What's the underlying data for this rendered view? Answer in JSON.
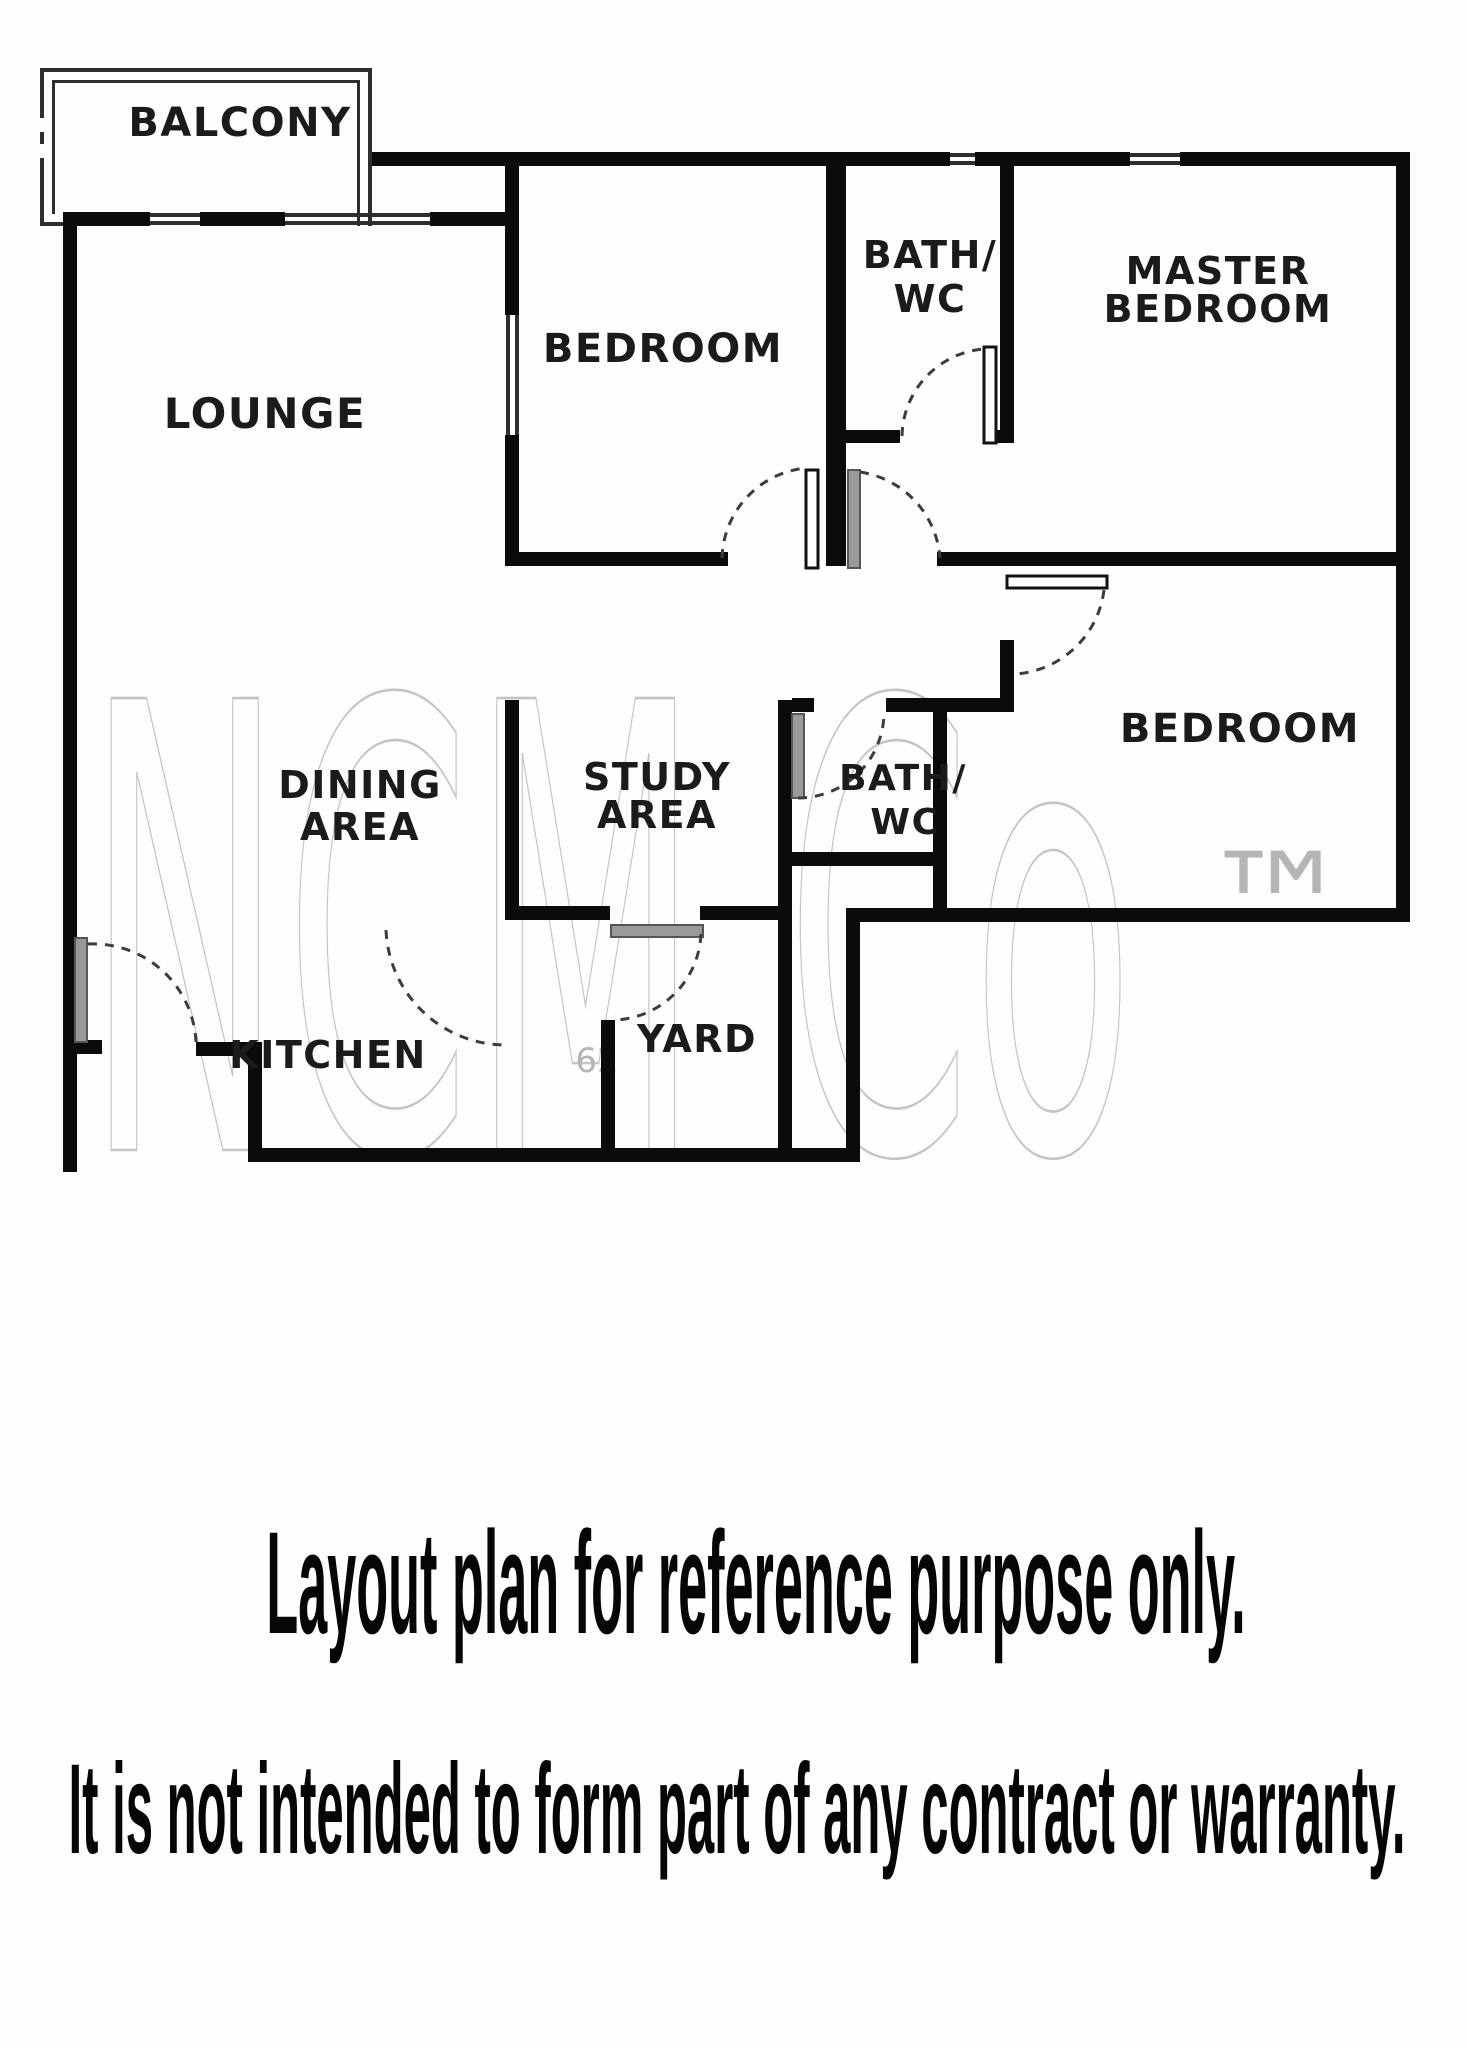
{
  "plan": {
    "rooms": [
      {
        "id": "balcony",
        "size": 40,
        "lines": [
          {
            "t": "BALCONY",
            "x": 240,
            "y": 136
          }
        ]
      },
      {
        "id": "lounge",
        "size": 42,
        "lines": [
          {
            "t": "LOUNGE",
            "x": 265,
            "y": 428
          }
        ]
      },
      {
        "id": "bedroom-top",
        "size": 40,
        "lines": [
          {
            "t": "BEDROOM",
            "x": 663,
            "y": 362
          }
        ]
      },
      {
        "id": "bath-wc-top",
        "size": 38,
        "lines": [
          {
            "t": "BATH/",
            "x": 930,
            "y": 268
          },
          {
            "t": "WC",
            "x": 930,
            "y": 312
          }
        ]
      },
      {
        "id": "master-bedroom",
        "size": 38,
        "lines": [
          {
            "t": "MASTER",
            "x": 1218,
            "y": 284
          },
          {
            "t": "BEDROOM",
            "x": 1218,
            "y": 322
          }
        ]
      },
      {
        "id": "bedroom-right",
        "size": 40,
        "lines": [
          {
            "t": "BEDROOM",
            "x": 1240,
            "y": 742
          }
        ]
      },
      {
        "id": "dining-area",
        "size": 38,
        "lines": [
          {
            "t": "DINING",
            "x": 360,
            "y": 798
          },
          {
            "t": "AREA",
            "x": 360,
            "y": 840
          }
        ]
      },
      {
        "id": "study-area",
        "size": 38,
        "lines": [
          {
            "t": "STUDY",
            "x": 657,
            "y": 790
          },
          {
            "t": "AREA",
            "x": 657,
            "y": 828
          }
        ]
      },
      {
        "id": "bath-wc-bottom",
        "size": 36,
        "lines": [
          {
            "t": "BATH/",
            "x": 903,
            "y": 790
          },
          {
            "t": "WC",
            "x": 905,
            "y": 834
          }
        ]
      },
      {
        "id": "kitchen",
        "size": 38,
        "lines": [
          {
            "t": "KITCHEN",
            "x": 328,
            "y": 1068
          }
        ]
      },
      {
        "id": "yard",
        "size": 38,
        "lines": [
          {
            "t": "YARD",
            "x": 697,
            "y": 1052
          }
        ]
      }
    ]
  },
  "watermark": {
    "brand": "NCM Co",
    "tm": "™",
    "number": "62"
  },
  "captions": {
    "line1": "Layout plan for reference purpose only.",
    "line2": "It is not intended to form part of any contract or warranty."
  },
  "colors": {
    "wall": "#0b0b0b",
    "label": "#1b1b1b",
    "watermark": "#c4c4c4",
    "caption": "#060606"
  }
}
